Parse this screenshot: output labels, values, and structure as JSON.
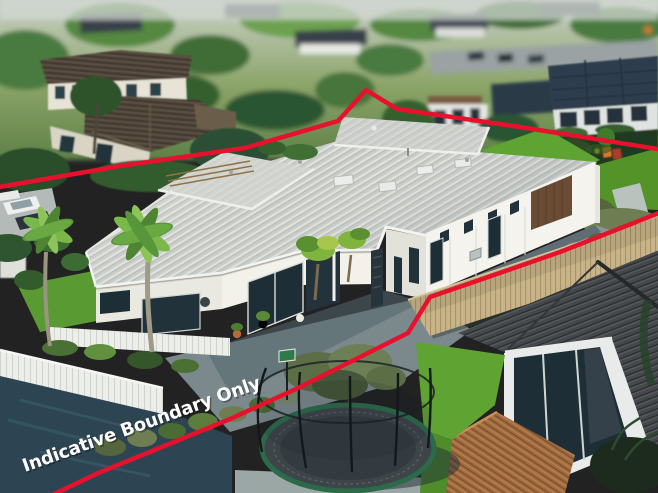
{
  "image": {
    "width": 658,
    "height": 493,
    "description": "Aerial drone photo of a single-level home with light grey metal roof outlined by a red indicative boundary line"
  },
  "watermark": {
    "text": "Indicative Boundary Only",
    "color": "#ffffff",
    "rotation_deg": -19.6,
    "font_size_px": 18
  },
  "boundary": {
    "color": "#e8112d",
    "stroke_width": 4.5,
    "rear_points": "-6,188 120,166 245,148 338,121 366,90 397,109 520,127 664,150",
    "front_points": "664,211 560,252 468,284 430,297 408,333 296,389 230,419 96,474 44,499"
  },
  "palette": {
    "roof_main": "#c8cbc6",
    "fascia": "#f3f4f1",
    "wall_sunlit": "#f2f1ea",
    "wall_shaded": "#e3e2da",
    "window_glass": "#1e2e37",
    "garage_door": "#6a4b33",
    "lawn": "#5fa332",
    "hedge_olive": "#6e7d52",
    "boundary_fence_tan": "#c7b488",
    "deck_timber": "#a26c40",
    "neighbour_roof_dark": "#45484a",
    "shadow_paving": "#2d4552",
    "paving_grey": "#7b898d",
    "trampoline_mat": "#3e4549",
    "trampoline_pad": "#2c6b4a",
    "haze": "#cdd3cd"
  },
  "features": [
    "main-house-grey-metal-roof",
    "garage-brown-door",
    "queen-palms",
    "white-fence",
    "trampoline-with-net",
    "olive-tree",
    "neighbour-house-dark-tile-roof",
    "timber-deck",
    "tan-boundary-fence",
    "hedge-row",
    "red-indicative-boundary-line"
  ]
}
